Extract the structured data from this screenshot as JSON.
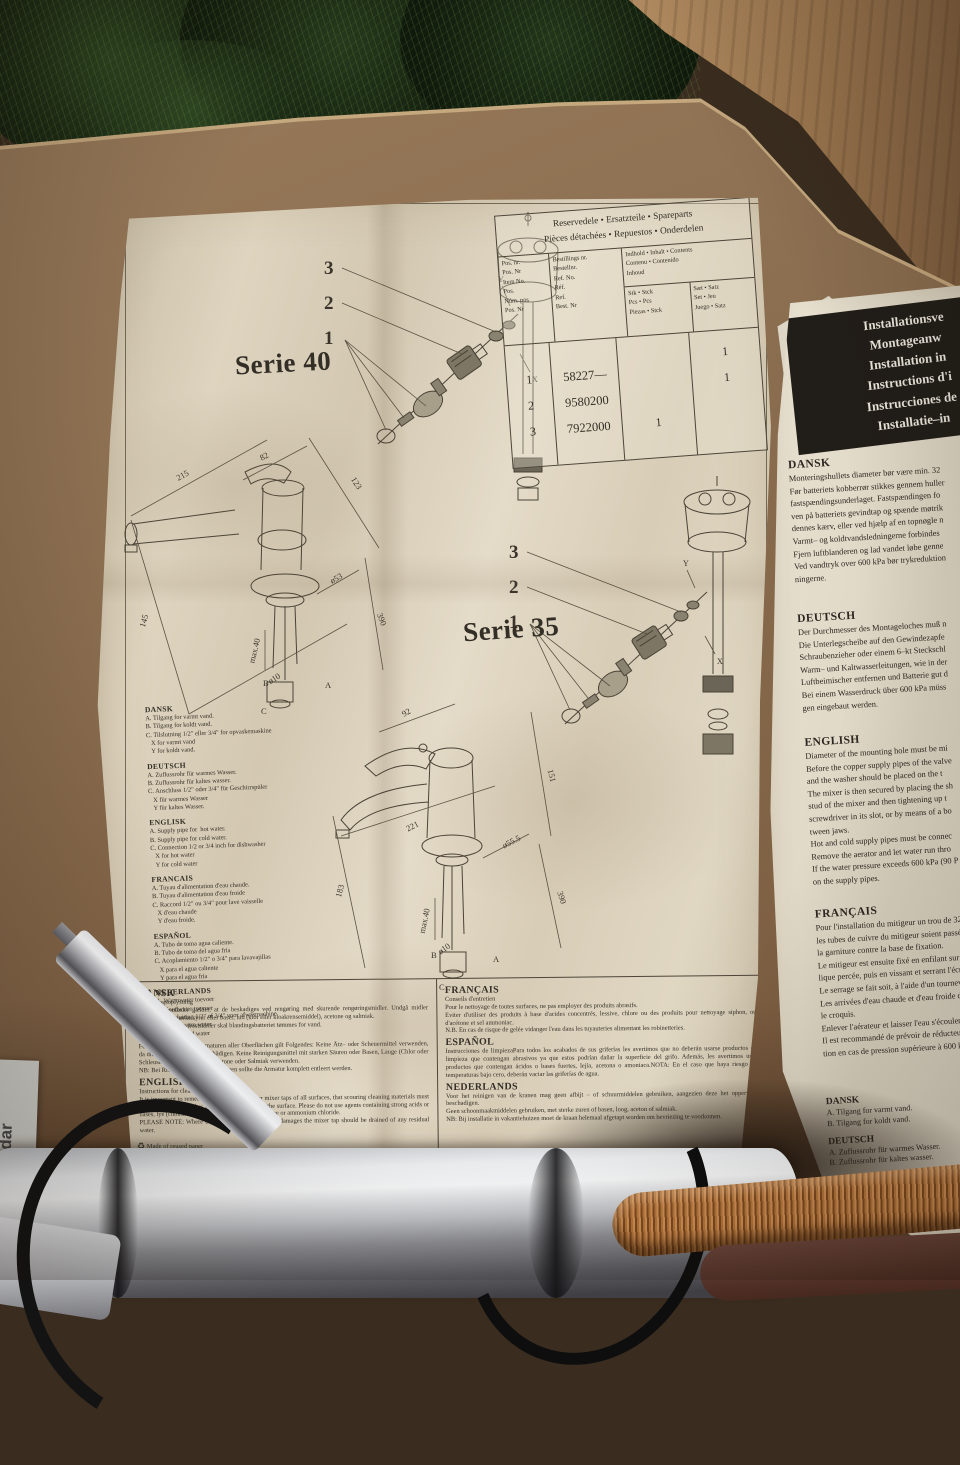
{
  "sheet1": {
    "serie40_label": "Serie 40",
    "serie35_label": "Serie 35",
    "exploded": {
      "n3": "3",
      "n2": "2",
      "n1": "1",
      "x": "X",
      "y": "Y"
    },
    "table": {
      "title": "Reservedele • Ersatzteile • Spareparts\nPièces détachées • Repuestos • Onderdelen",
      "col_pos": "Pos. nr.\nPos. Nr\nItem No.\nPos.\nNúm. pos\nPos. Nr",
      "col_ref": "Bestillings nr.\nBestellnr.\nRef. No.\nRéf.\nRef.\nBest. Nr",
      "col_contents": "Indhold • Inhalt • Contents\nContenu • Contenido\nInhoud",
      "col_stk": "Stk • Stck\nPcs • Pcs\nPiezas • Stck",
      "col_saet": "Sæt • Satz\nSet • Jeu\nJuego • Satz",
      "rows": [
        {
          "pos": "1",
          "ref": "58227—",
          "stk": "",
          "saet": "1"
        },
        {
          "pos": "2",
          "ref": "9580200",
          "stk": "",
          "saet": "1"
        },
        {
          "pos": "3",
          "ref": "7922000",
          "stk": "1",
          "saet": ""
        }
      ]
    },
    "dims40": {
      "d215": "215",
      "d82": "82",
      "d123": "123",
      "d145": "145",
      "dmax": "max.40",
      "d10": "ø10",
      "d53": "ø53",
      "d390": "390",
      "a": "A",
      "b": "B",
      "c": "C"
    },
    "dims35": {
      "d92": "92",
      "d151": "151",
      "d221": "221",
      "d183": "183",
      "dmax": "max.40",
      "d10": "ø10",
      "d555": "ø55.5",
      "d390": "390",
      "a": "A",
      "b": "B",
      "c": "C"
    },
    "abc_lists": [
      {
        "title": "DANSK",
        "body": "A. Tilgang for varmt vand.\nB. Tilgang for koldt vand.\nC. Tilslutning 1/2\" eller 3/4\" for opvaskemaskine\n   X for varmt vand\n   Y for koldt vand."
      },
      {
        "title": "DEUTSCH",
        "body": "A. Zuflussrohr für warmes Wasser.\nB. Zuflussrohr für kaltes wasser.\nC. Anschluss 1/2\" oder 3/4\" für Geschirrspüler\n   X für warmes Wasser\n   Y für kaltes Wasser."
      },
      {
        "title": "ENGLISK",
        "body": "A. Supply pipe for  hot water.\nB. Supply pipe for cold water.\nC. Connection 1/2 or 3/4 inch for dishwasher\n   X for hot water\n   Y for cold water"
      },
      {
        "title": "FRANCAIS",
        "body": "A. Tuyau d'alimentation d'eau chaude.\nB. Tuyau d'alimentation d'eau froide\nC. Raccord 1/2\" ou 3/4\" pour lave vaisselle\n   X d'eau chaude\n   Y d'eau froide."
      },
      {
        "title": "ESPAÑOL",
        "body": "A. Tubo de toma agua caliente.\nB. Tubo de toma del agua fría\nC. Acoplamiento 1/2\" o 3/4\" para lavavajillas\n   X para el agua caliente\n   Y para el agua fría"
      },
      {
        "title": "NEDERLANDS",
        "body": "A. Warmwater toevoer\nB. Koudwater toevoer\nC. Aansluiting 1/2\" of 3/4\" voor afwasmachine\n   X voor warm water\n   Y voor koud water"
      }
    ],
    "cleaning_left": [
      {
        "title": "DANSK",
        "sub": "Rengøringsoplysning",
        "body": "For alle overflader gælder, at de beskadiges ved rengøring med skurende rengøringsmidler. Undgå midler indeholdende stærke syrer eller baser, lud (klor eller kloakrensemiddel), acetone og salmiak.\nNB: Ved risiko for frostskader skal blandingsbatteriet tømmes for vand."
      },
      {
        "title": "DEUTSCH",
        "sub": "",
        "body": "Für die Reinigung der Armaturen aller Oberflächen gilt Folgendes: Keine Ätz– oder Scheuermittel verwenden, da diese die Oberfläche beschädigen. Keine Reinigungsmittel mit starken Säuren oder Basen, Lauge (Chlor oder Schleusenreinigungsmittel), Azetone oder Salmiak verwenden.\nNB: Bei Risiko für Frosteinwirkungen sollte die Armatur komplett entleert werden."
      },
      {
        "title": "ENGLISH",
        "sub": "Instructions for cleaning fittings",
        "body": "It is important to remember when cleaning your mixer taps of all surfaces, that scouring cleaning materials must on no account be used as these are apt to damage the surface. Please do not use agents containing strong acids or bases, lye (chlorine or sink cleaning material), acetone or ammonium chloride.\nPLEASE NOTE: Where there may be a risk of frost damages the mixer tap should be drained of any residual water."
      }
    ],
    "cleaning_right": [
      {
        "title": "FRANÇAIS",
        "sub": "Conseils d'entretien",
        "body": "Pour le nettoyage de toutes surfaces, ne pas employer des produits abrasifs.\nEviter d'utiliser des produits à base d'acides concentrés, lessive, chlore ou des produits pour nettoyage siphon, ou d'acétone et sel ammoniac.\nN.B. En cas de risque de gelée vidanger l'eau dans les tuyauteries alimentant les robinetteries."
      },
      {
        "title": "ESPAÑOL",
        "sub": "",
        "body": "Instrucciones de limpiezaPara todos los acabados de sus griferías les avertimos que no deberán usarse productos de limpieza que contengan abrasivos ya que estos podrían dañar la superficie del grifo. Además, les avertimos usar productos que contengan ácidos o bases fuertes, lejía, acetona o amoniaca.NOTA: En el caso que haya riesgo de temperaturas bajo cero, deberán vaciar las griferías de agua."
      },
      {
        "title": "NEDERLANDS",
        "sub": "",
        "body": "Voor het reinigen van de kranen mag geen afbijt – of schuurmiddelen gebruiken, aangezien deze het oppervlak beschadigen.\nGeen schoonmaakmiddelen gebruiken, met sterke zuren of basen, loog, aceton of salmiak.\nNB: Bij installatie in vakantiehuizen moet de kraan helemaal afgetapt worden om bevriezing te voorkomen."
      }
    ],
    "recycle_icon": "♻",
    "recycle_note": "Made of reused paper"
  },
  "sheet2": {
    "banner": "Installationsve\nMontageanw\nInstallation in\nInstructions d'i\nInstrucciones de\nInstallatie–in",
    "sections": [
      {
        "title": "DANSK",
        "body": "Monteringshullets diameter bør være min. 32\nFør batteriets kobberrør stikkes gennem huller\nfastspændingsunderlaget. Fastspændingen fo\nven på batteriets gevindtap og spænde møtrik\ndennes kærv, eller ved hjælp af en topnøgle n\nVarmt– og koldtvandsledningerne forbindes\nFjern luftblanderen og lad vandet løbe genne\nVed vandtryk over 600 kPa bør trykreduktion\nningerne."
      },
      {
        "title": "DEUTSCH",
        "body": "Der Durchmesser des Montageloches muß n\nDie Unterlegscheibe auf den Gewindezapfe\nSchraubenzieher oder einem 6–kt Steckschl\nWarm– und Kaltwasserleitungen, wie in der\nLuftbeimischer entfernen und Batterie gut d\nBei einem Wasserdruck über 600 kPa müss\ngen eingebaut werden."
      },
      {
        "title": "ENGLISH",
        "body": "Diameter of the mounting hole must be mi\nBefore the copper supply pipes of the valve\nand the washer should be placed on the t\nThe mixer is then secured by placing the sh\nstud of the mixer and then tightening up t\nscrewdriver in its slot, or by means of a bo\ntween jaws.\nHot and cold supply pipes must be connec\nRemove the aerator and let water run thro\nIf the water pressure exceeds 600 kPa (90 P\non the supply pipes."
      },
      {
        "title": "FRANÇAIS",
        "body": "Pour l'installation du mitigeur un trou de 32\nles tubes de cuivre du mitigeur soient passés\nla garniture contre la base de fixation.\nLe mitigeur est ensuite fixé en enfilant sur la t\nlique percée, puis en vissant et serrant l'écrou\nLe serrage se fait soit, à l'aide d'un tournevis s\nLes arrivées d'eau chaude et d'eau froide doiv\nle croquis.\nEnlever l'aérateur et laisser l'eau s'écouler pa\nIl est recommandé de prévoir de réducteurs de\ntion en cas de pression supérieure à 600 kPa."
      }
    ],
    "bottom_left": [
      {
        "title": "DANSK",
        "body": "A. Tilgang for varmt vand.\nB. Tilgang for koldt vand."
      },
      {
        "title": "DEUTSCH",
        "body": "A. Zuflussrohr für warmes Wasser.\nB. Zuflussrohr für kaltes wasser."
      },
      {
        "title": "ENGLISK",
        "body": "A. Supply pipe for  hot water.\nB. Supply pipe for cold water."
      }
    ],
    "bottom_right": [
      {
        "title": "FRAN",
        "body": "A. Tuya\nB. Tuya"
      },
      {
        "title": "ESPAÑ",
        "body": "A. Tubo\nB. Tubo"
      },
      {
        "title": "NEDER",
        "body": "A. Warm\nB. Koud"
      }
    ]
  },
  "foreground": {
    "box_label": "dar"
  }
}
